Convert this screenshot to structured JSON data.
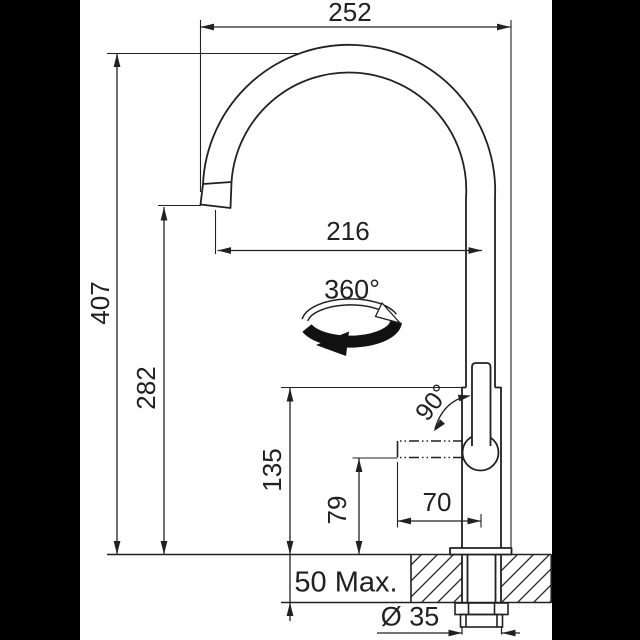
{
  "labels": {
    "spout_width": "252",
    "total_height": "407",
    "spout_reach": "216",
    "spout_clearance": "282",
    "swivel_angle": "360°",
    "handle_angle": "90°",
    "body_height": "135",
    "handle_clearance": "79",
    "handle_reach": "70",
    "deck_thickness": "50 Max.",
    "hole_diameter": "Ø 35"
  },
  "colors": {
    "ink": "#212121",
    "paper": "#ffffff",
    "background": "#000000"
  }
}
